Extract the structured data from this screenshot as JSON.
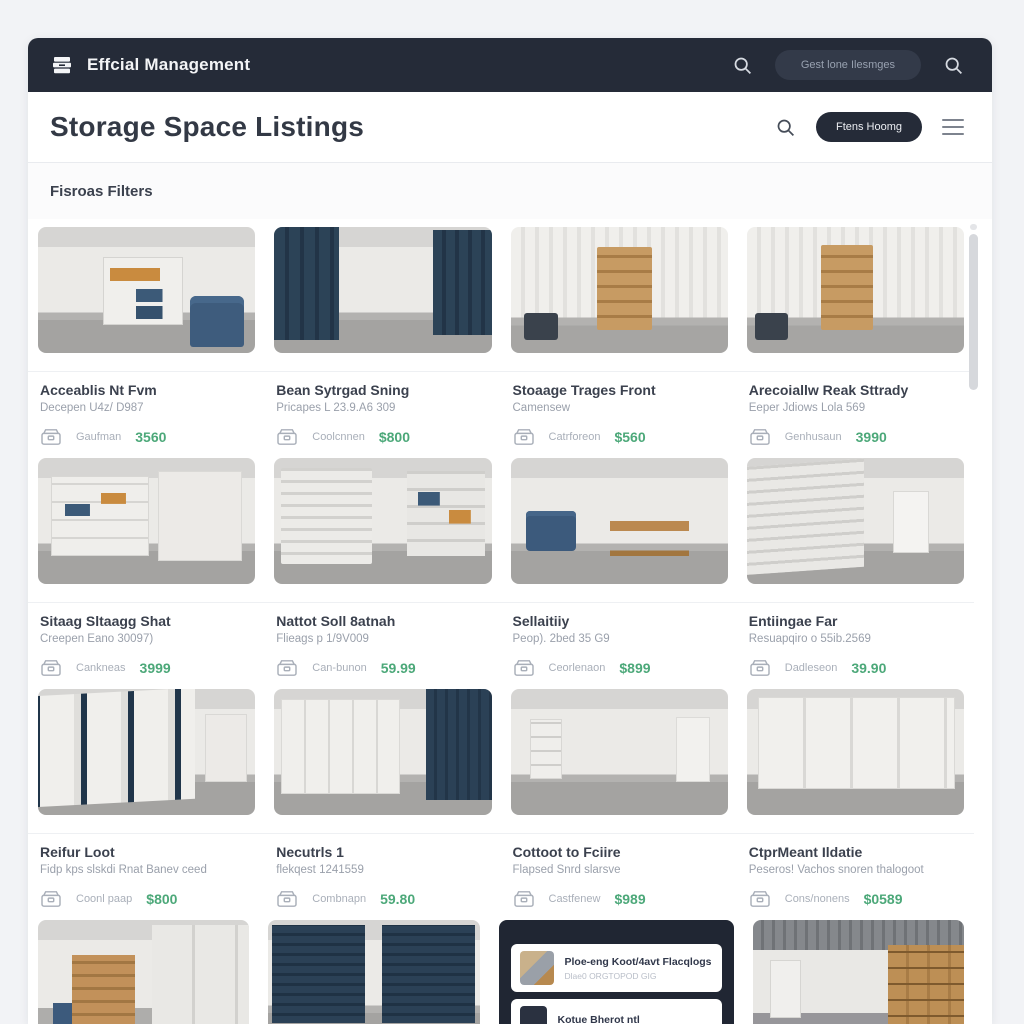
{
  "navbar": {
    "brand": "Effcial Management",
    "pill_button": "Gest lone Ilesmges"
  },
  "header": {
    "title": "Storage Space Listings",
    "filter_button": "Ftens Hoomg"
  },
  "filters_label": "Fisroas Filters",
  "cards": [
    {
      "title": "Acceablis Nt Fvm",
      "subtitle": "Decepen U4z/ D987",
      "vendor": "Gaufman",
      "price": "3560",
      "photo": "white storage room with cube shelving, orange and blue bins, blue armchair"
    },
    {
      "title": "Bean Sytrgad Sning",
      "subtitle": "Pricapes L 23.9.A6 309",
      "vendor": "Coolcnnen",
      "price": "$800",
      "photo": "corridor of navy corrugated storage unit doors with concrete floor"
    },
    {
      "title": "Stoaage Trages Front",
      "subtitle": "Camensew",
      "vendor": "Catrforeon",
      "price": "$560",
      "photo": "white corrugated unit with stacked wooden drawers and dark bin"
    },
    {
      "title": "Arecoiallw Reak Sttrady",
      "subtitle": "Eeper Jdiows Lola 569",
      "vendor": "Genhusaun",
      "price": "3990",
      "photo": "white corrugated unit with stacked wooden drawers and dark bin"
    },
    {
      "title": "Sitaag Sltaagg Shat",
      "subtitle": "Creepen Eano 30097)",
      "vendor": "Cankneas",
      "price": "3999",
      "photo": "white cabinets and shelves holding blue and orange storage bins"
    },
    {
      "title": "Nattot Soll 8atnah",
      "subtitle": "Flieags p 1/9V009",
      "vendor": "Can-bunon",
      "price": "59.99",
      "photo": "white roller door beside shelving unit with bins"
    },
    {
      "title": "Sellaitiiy",
      "subtitle": "Peop). 2bed 35 G9",
      "vendor": "Ceorlenaon",
      "price": "$899",
      "photo": "bright room with windows, blue sofa and wooden workbench"
    },
    {
      "title": "Entiingae Far",
      "subtitle": "Resuapqiro o 55ib.2569",
      "vendor": "Dadleseon",
      "price": "39.90",
      "photo": "large white roller shutter in empty garage with grey floor"
    },
    {
      "title": "Reifur Loot",
      "subtitle": "Fidp kps slskdi Rnat Banev ceed",
      "vendor": "Coonl paap",
      "price": "$800",
      "photo": "white roller doors with navy dividers in perspective"
    },
    {
      "title": "Necutrls 1",
      "subtitle": "flekqest 1241559",
      "vendor": "Combnapn",
      "price": "59.80",
      "photo": "white cabinets next to navy corrugated wall"
    },
    {
      "title": "Cottoot to Fciire",
      "subtitle": "Flapsed Snrd slarsve",
      "vendor": "Castfenew",
      "price": "$989",
      "photo": "empty white room with small shelf and door"
    },
    {
      "title": "CtprMeant Ildatie",
      "subtitle": "Peseros! Vachos snoren thalogoot",
      "vendor": "Cons/nonens",
      "price": "$0589",
      "photo": "wall of white cabinet doors in storage room"
    }
  ],
  "bottom_photos": {
    "p13": "room with wooden pallet shelving, blue bin and white cabinets",
    "p14": "two navy roller doors separated by white pillar",
    "p16": "warehouse with corrugated ceiling, wooden crate shelving and white door"
  },
  "notification": {
    "item1_title": "Ploe-eng Koot/4avt Flacqlogs",
    "item1_sub": "Dlae0 ORGTOPOD GIG",
    "item2_title": "Kotue Bherot ntl"
  },
  "colors": {
    "navbar": "#252b38",
    "accent_green": "#4ca879",
    "page_bg": "#f2f3f6",
    "navy_door": "#2b4156"
  }
}
